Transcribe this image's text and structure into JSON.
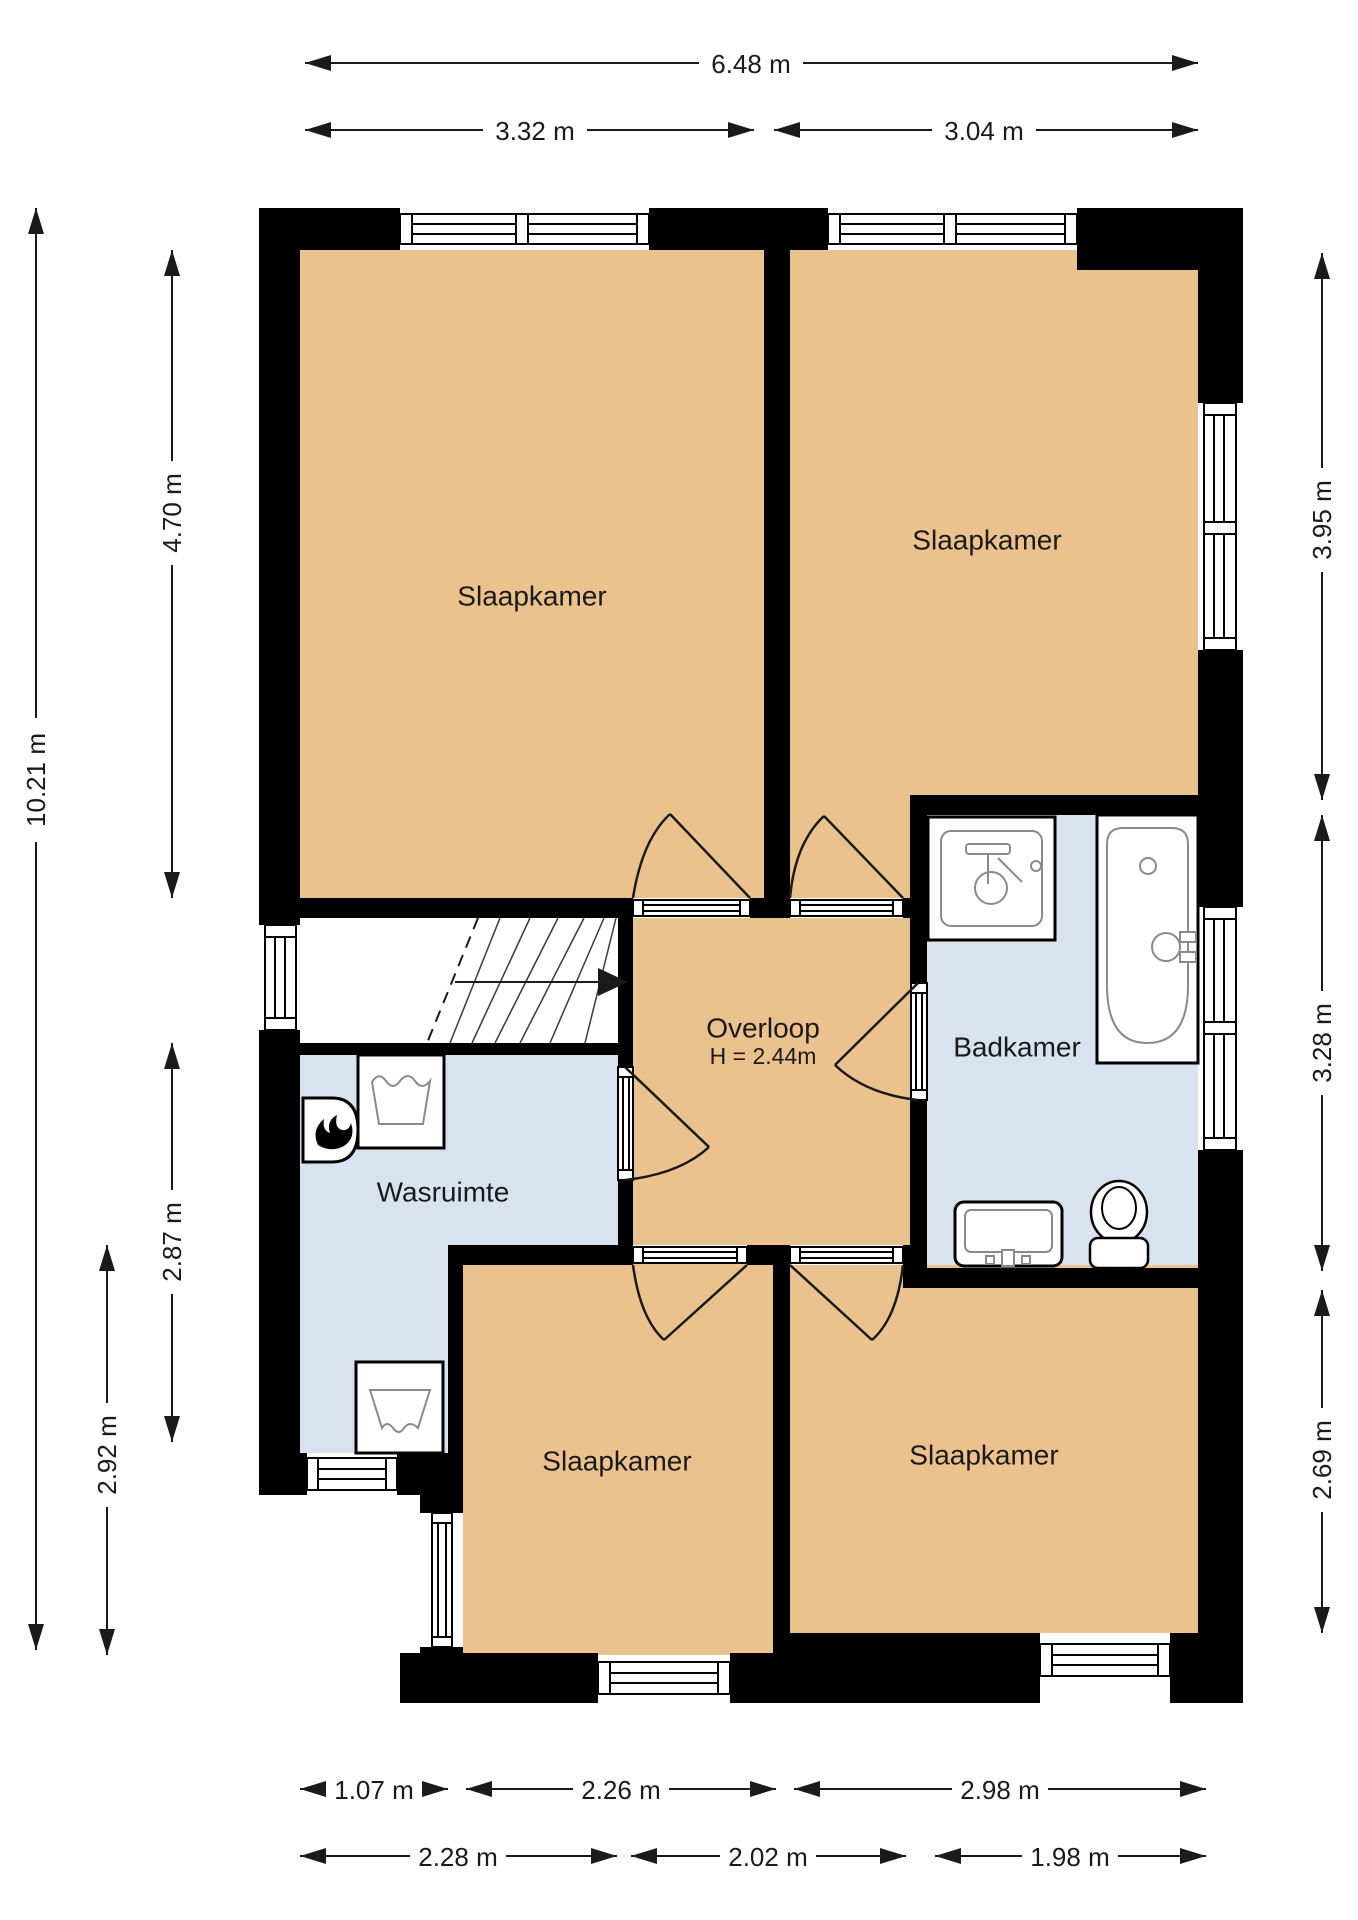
{
  "colors": {
    "floor-room": "#EBC28D",
    "floor-wet": "#D9E3F0",
    "wall": "#000000",
    "line": "#1A1A1A",
    "text": "#1A1A1A",
    "bg": "#FFFFFF"
  },
  "plan": {
    "floor_type": "floorplan",
    "rooms": {
      "bedroom_top_left": {
        "label": "Slaapkamer"
      },
      "bedroom_top_right": {
        "label": "Slaapkamer"
      },
      "landing": {
        "label": "Overloop",
        "height_note": "H = 2.44m"
      },
      "bathroom": {
        "label": "Badkamer"
      },
      "laundry": {
        "label": "Wasruimte"
      },
      "bedroom_bottom_left": {
        "label": "Slaapkamer"
      },
      "bedroom_bottom_right": {
        "label": "Slaapkamer"
      }
    },
    "dimensions": {
      "top": [
        {
          "label": "6.48 m"
        },
        {
          "label": "3.32 m"
        },
        {
          "label": "3.04 m"
        }
      ],
      "bottom_inner": [
        {
          "label": "1.07 m"
        },
        {
          "label": "2.26 m"
        },
        {
          "label": "2.98 m"
        }
      ],
      "bottom_outer": [
        {
          "label": "2.28 m"
        },
        {
          "label": "2.02 m"
        },
        {
          "label": "1.98 m"
        }
      ],
      "left": [
        {
          "label": "10.21 m"
        },
        {
          "label": "4.70 m"
        },
        {
          "label": "2.87 m"
        },
        {
          "label": "2.92 m"
        }
      ],
      "right": [
        {
          "label": "3.95 m"
        },
        {
          "label": "3.28 m"
        },
        {
          "label": "2.69 m"
        }
      ]
    },
    "icons": {
      "stairs_direction": "arrow-right",
      "boiler": "flame",
      "washer": "wash-tub-symbol",
      "dryer": "dry-tub-symbol"
    }
  }
}
